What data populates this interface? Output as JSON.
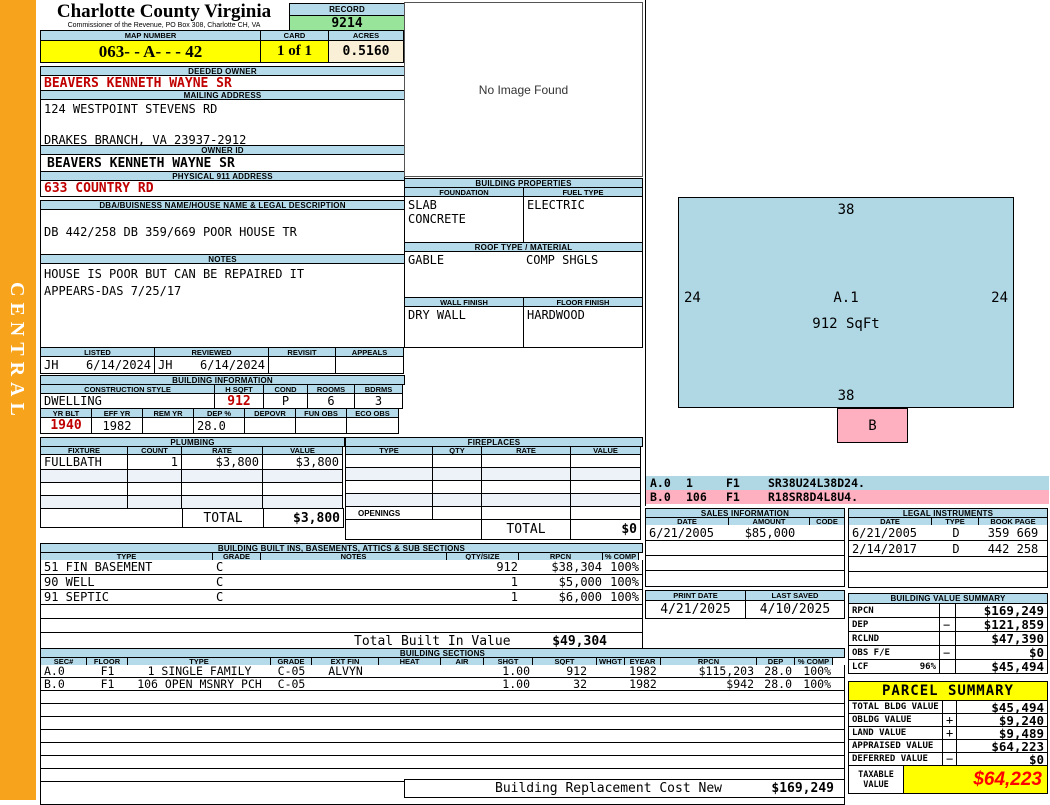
{
  "district": "CENTRAL",
  "header": {
    "county": "Charlotte County Virginia",
    "subtitle": "Commissioner of the Revenue, PO Box 308, Charlotte CH, VA",
    "record_label": "RECORD",
    "record": "9214",
    "map_number_label": "MAP NUMBER",
    "map_number": "063- - A- -  - 42",
    "card_label": "CARD",
    "card": "1 of 1",
    "acres_label": "ACRES",
    "acres": "0.5160"
  },
  "owner": {
    "deeded_owner_label": "DEEDED OWNER",
    "deeded_owner": "BEAVERS KENNETH WAYNE SR",
    "mailing_label": "MAILING ADDRESS",
    "mailing_line1": "124 WESTPOINT STEVENS RD",
    "mailing_line2": "DRAKES BRANCH, VA 23937-2912",
    "owner_id_label": "OWNER ID",
    "owner_id": "BEAVERS KENNETH WAYNE SR",
    "physical_label": "PHYSICAL 911 ADDRESS",
    "physical": "633 COUNTRY RD",
    "dba_label": "DBA/BUISNESS NAME/HOUSE NAME & LEGAL DESCRIPTION",
    "legal_description": "DB 442/258 DB 359/669 POOR HOUSE TR",
    "notes_label": "NOTES",
    "notes_line1": "HOUSE IS POOR BUT CAN BE REPAIRED IT",
    "notes_line2": "APPEARS-DAS 7/25/17"
  },
  "review": {
    "listed_label": "LISTED",
    "reviewed_label": "REVIEWED",
    "revisit_label": "REVISIT",
    "appeals_label": "APPEALS",
    "listed_by": "JH",
    "listed_date": "6/14/2024",
    "reviewed_by": "JH",
    "reviewed_date": "6/14/2024",
    "revisit": "",
    "appeals": ""
  },
  "building_info": {
    "title": "BUILDING INFORMATION",
    "style_label": "CONSTRUCTION STYLE",
    "hsqft_label": "H SQFT",
    "cond_label": "COND",
    "rooms_label": "ROOMS",
    "bdrms_label": "BDRMS",
    "style": "DWELLING",
    "hsqft": "912",
    "cond": "P",
    "rooms": "6",
    "bdrms": "3",
    "yrblt_label": "YR BLT",
    "effyr_label": "EFF YR",
    "remyr_label": "REM YR",
    "dep_label": "DEP %",
    "depovr_label": "DEPOVR",
    "funobs_label": "FUN OBS",
    "ecoobs_label": "ECO OBS",
    "yrblt": "1940",
    "effyr": "1982",
    "remyr": "",
    "dep": "28.0",
    "depovr": "",
    "funobs": "",
    "ecoobs": ""
  },
  "plumbing": {
    "title": "PLUMBING",
    "headers": [
      "FIXTURE",
      "COUNT",
      "RATE",
      "VALUE"
    ],
    "rows": [
      [
        "FULLBATH",
        "1",
        "$3,800",
        "$3,800"
      ]
    ],
    "total_label": "TOTAL",
    "total": "$3,800"
  },
  "fireplaces": {
    "title": "FIREPLACES",
    "headers": [
      "TYPE",
      "QTY",
      "RATE",
      "VALUE"
    ],
    "openings_label": "OPENINGS",
    "total_label": "TOTAL",
    "total": "$0"
  },
  "built_ins": {
    "title": "BUILDING BUILT INS, BASEMENTS, ATTICS & SUB SECTIONS",
    "headers": [
      "TYPE",
      "GRADE",
      "NOTES",
      "QTY/SIZE",
      "RPCN",
      "% COMP"
    ],
    "rows": [
      [
        "51 FIN BASEMENT",
        "C",
        "",
        "912",
        "$38,304",
        "100%"
      ],
      [
        "90 WELL",
        "C",
        "",
        "1",
        "$5,000",
        "100%"
      ],
      [
        "91 SEPTIC",
        "C",
        "",
        "1",
        "$6,000",
        "100%"
      ]
    ],
    "total_label": "Total Built In Value",
    "total": "$49,304"
  },
  "building_sections": {
    "title": "BUILDING SECTIONS",
    "headers": [
      "SEC#",
      "FLOOR",
      "TYPE",
      "GRADE",
      "EXT FIN",
      "HEAT",
      "AIR",
      "SHGT",
      "SQFT",
      "WHGT",
      "EYEAR",
      "RPCN",
      "DEP",
      "% COMP"
    ],
    "rows": [
      [
        "A.0",
        "F1",
        "1 SINGLE FAMILY",
        "C-05",
        "ALVYN",
        "",
        "",
        "1.00",
        "912",
        "",
        "1982",
        "$115,203",
        "28.0",
        "100%"
      ],
      [
        "B.0",
        "F1",
        "106 OPEN MSNRY PCH",
        "C-05",
        "",
        "",
        "",
        "1.00",
        "32",
        "",
        "1982",
        "$942",
        "28.0",
        "100%"
      ]
    ],
    "replacement_label": "Building Replacement Cost New",
    "replacement_value": "$169,249"
  },
  "image_box": {
    "text": "No Image Found"
  },
  "properties": {
    "title": "BUILDING PROPERTIES",
    "foundation_label": "FOUNDATION",
    "fuel_label": "FUEL TYPE",
    "foundation_line1": "SLAB",
    "foundation_line2": "CONCRETE",
    "fuel": "ELECTRIC",
    "roof_label": "ROOF TYPE / MATERIAL",
    "roof_type": "GABLE",
    "roof_material": "COMP SHGLS",
    "wall_label": "WALL FINISH",
    "floor_label": "FLOOR FINISH",
    "wall": "DRY WALL",
    "floor": "HARDWOOD"
  },
  "sketch": {
    "area_label": "A.1",
    "area_sqft": "912 SqFt",
    "dim_top": "38",
    "dim_left": "24",
    "dim_right": "24",
    "dim_bottom": "38",
    "porch_label": "B",
    "codes": [
      {
        "sec": "A.0",
        "num": "1",
        "floor": "F1",
        "code": "SR38U24L38D24."
      },
      {
        "sec": "B.0",
        "num": "106",
        "floor": "F1",
        "code": "R18SR8D4L8U4."
      }
    ]
  },
  "sales": {
    "title": "SALES INFORMATION",
    "headers": [
      "DATE",
      "AMOUNT",
      "CODE"
    ],
    "rows": [
      [
        "6/21/2005",
        "$85,000",
        ""
      ]
    ]
  },
  "print_info": {
    "print_date_label": "PRINT DATE",
    "print_date": "4/21/2025",
    "last_saved_label": "LAST SAVED",
    "last_saved": "4/10/2025"
  },
  "legal": {
    "title": "LEGAL INSTRUMENTS",
    "headers": [
      "DATE",
      "TYPE",
      "BOOK PAGE"
    ],
    "rows": [
      [
        "6/21/2005",
        "D",
        "359 669"
      ],
      [
        "2/14/2017",
        "D",
        "442 258"
      ]
    ]
  },
  "value_summary": {
    "title": "BUILDING VALUE SUMMARY",
    "rows": [
      [
        "RPCN",
        "",
        "",
        "$169,249"
      ],
      [
        "DEP",
        "",
        "−",
        "$121,859"
      ],
      [
        "RCLND",
        "",
        "",
        "$47,390"
      ],
      [
        "OBS F/E",
        "",
        "−",
        "$0"
      ],
      [
        "LCF",
        "96%",
        "",
        "$45,494"
      ]
    ]
  },
  "parcel_summary": {
    "title": "PARCEL SUMMARY",
    "rows": [
      [
        "TOTAL BLDG VALUE",
        "",
        "$45,494"
      ],
      [
        "OBLDG VALUE",
        "+",
        "$9,240"
      ],
      [
        "LAND VALUE",
        "+",
        "$9,489"
      ],
      [
        "APPRAISED VALUE",
        "",
        "$64,223"
      ],
      [
        "DEFERRED VALUE",
        "−",
        "$0"
      ]
    ],
    "taxable_label1": "TAXABLE",
    "taxable_label2": "VALUE",
    "taxable": "$64,223"
  },
  "colors": {
    "accent_orange": "#F7A41C",
    "bar_blue": "#B5DBEA",
    "highlight_yellow": "#FFFF00",
    "record_green": "#98E49B",
    "acres_cream": "#FAF0D7",
    "value_red": "#C00000",
    "taxable_red": "#FF0000",
    "sketch_blue": "#AFD7E4",
    "sketch_pink": "#FFB0C0"
  }
}
